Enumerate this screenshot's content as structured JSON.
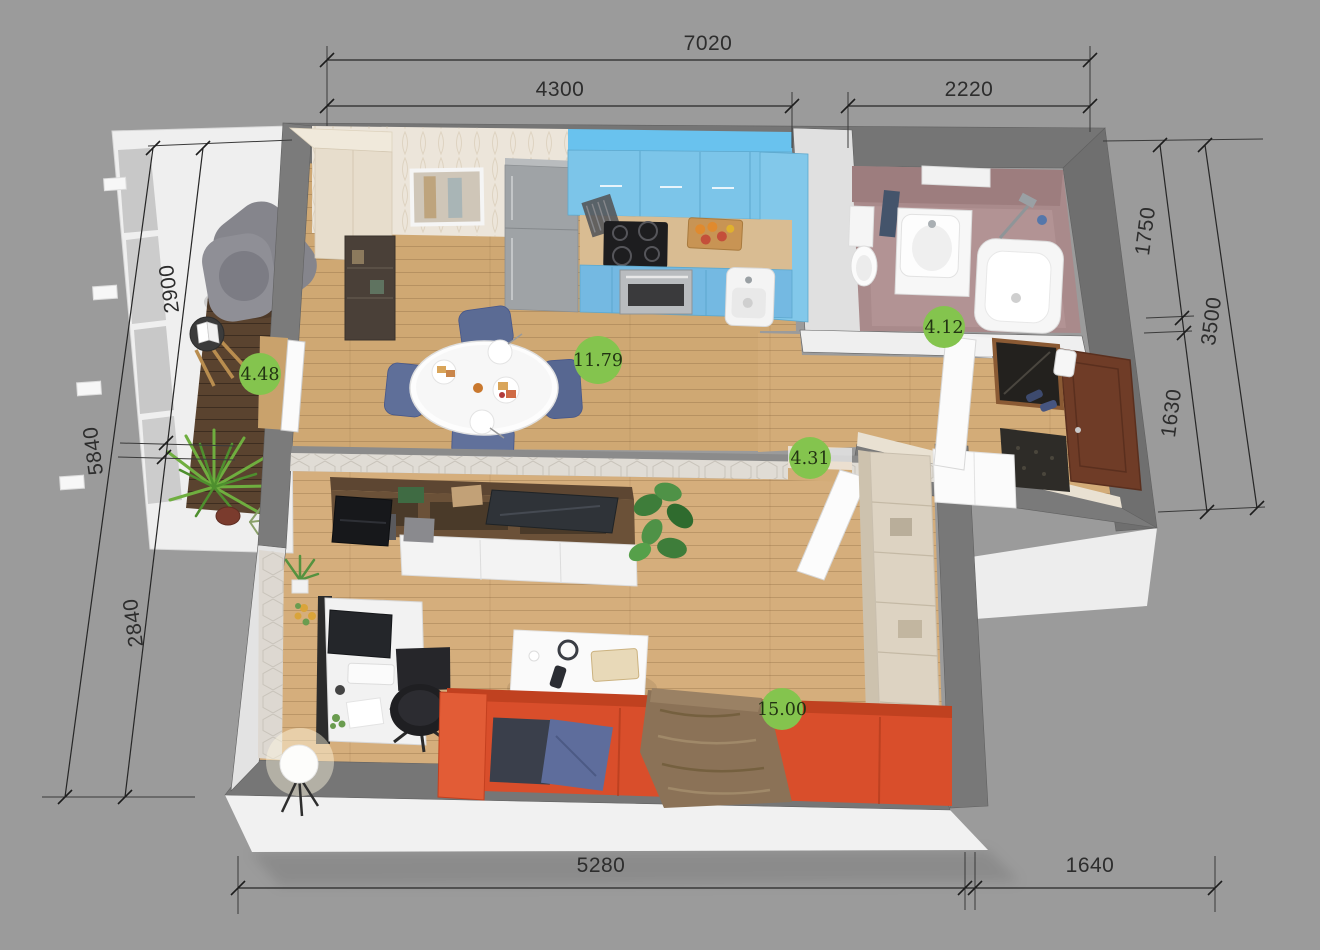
{
  "palette": {
    "background": "#9b9b9b",
    "wall_gray": "#757575",
    "exterior_white": "#f0f0f0",
    "floor_wood": "#d0a974",
    "balcony_wood": "#5a432f",
    "kitchen_blue": "#7cc5e9",
    "bathroom_mauve": "#a98a8b",
    "sofa_red": "#d94e2b",
    "badge_green": "#84c44e",
    "badge_text": "#223313",
    "dimension_text": "#2d2d2d"
  },
  "dimensions": {
    "top": {
      "overall": "7020",
      "segments": [
        "4300",
        "2220"
      ]
    },
    "bottom": {
      "segments": [
        "5280",
        "1640"
      ]
    },
    "left": {
      "overall": "5840",
      "segments": [
        "2900",
        "2840"
      ]
    },
    "right": {
      "overall": "3500",
      "segments": [
        "1750",
        "1630"
      ]
    }
  },
  "areas": {
    "balcony": "4.48",
    "kitchen_dining": "11.79",
    "bathroom": "4.12",
    "hallway": "4.31",
    "living_room": "15.00"
  }
}
